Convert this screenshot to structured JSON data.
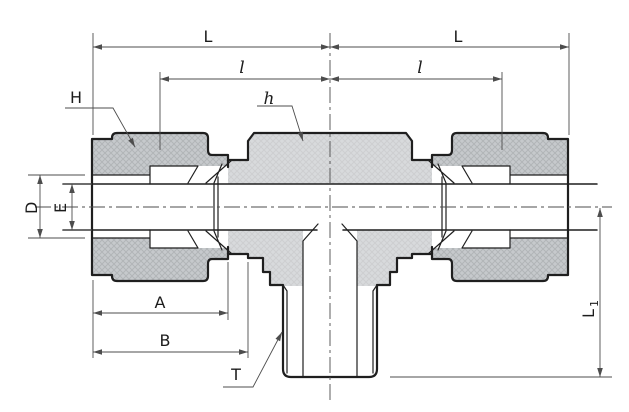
{
  "drawing": {
    "title": "Tee tube fitting cross-section technical drawing",
    "labels": {
      "dim_L_left": "L",
      "dim_L_right": "L",
      "dim_l_left": "l",
      "dim_l_right": "l",
      "label_H": "H",
      "label_h": "h",
      "dim_D": "D",
      "dim_E": "E",
      "dim_A": "A",
      "dim_B": "B",
      "label_T": "T",
      "dim_L1_main": "L",
      "dim_L1_sub": "1"
    },
    "colors": {
      "outline": "#1f1f1f",
      "dimension": "#4d4d4d",
      "body_fill": "#d8dadc",
      "nut_fill": "#c6c9cc",
      "background": "#ffffff"
    }
  }
}
